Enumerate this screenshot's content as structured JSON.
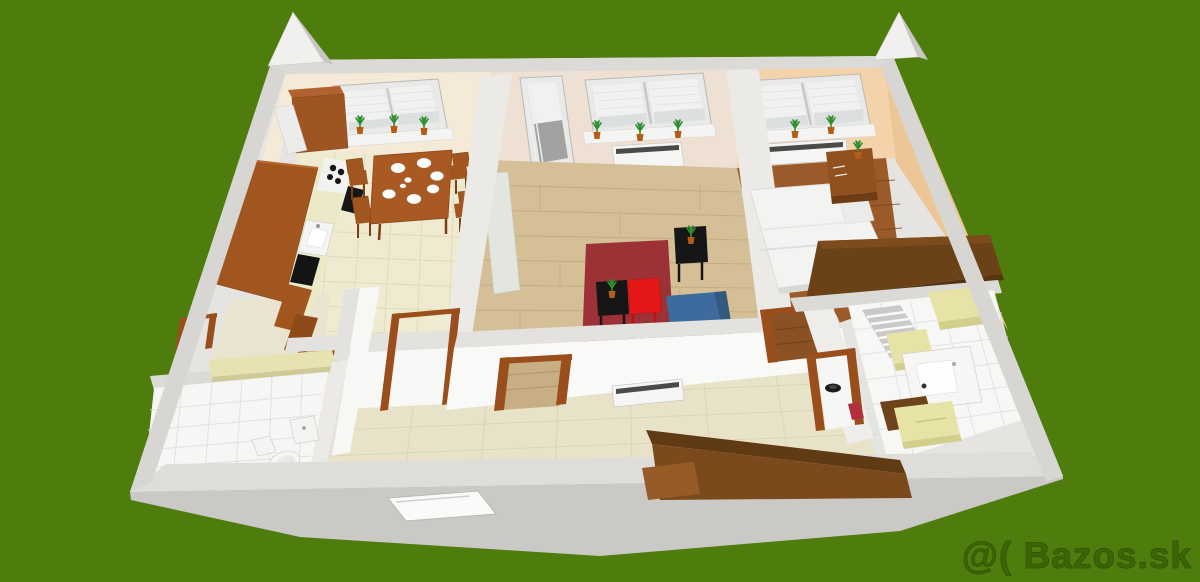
{
  "scene": {
    "type": "3d-floor-plan-render",
    "watermark": "@( Bazos.sk"
  },
  "colors": {
    "bg-green": "#4e7d0e",
    "watermark": "#3c6407",
    "watermark-outline": "#2c4f04",
    "shell-base": "#e6e4e0",
    "wall-top": "#e4e2de",
    "wall-top2": "#dfddd9",
    "wall-band": "#d8d6d2",
    "wall-band-dark": "#dcdad6",
    "outer-face": "#cbc9c5",
    "gable": "#f1f0ee",
    "gable-side": "#c9c7c3",
    "wall-white": "#f8f8f6",
    "wall-speckle": "#eceae6",
    "wall-cream": "#f5e9d8",
    "wall-cream2": "#efe0d4",
    "wall-peach": "#f4d2aa",
    "wall-peach-east": "#edc698",
    "floor-kitchen": "#efebd0",
    "grid-kitchen": "#ddd6b6",
    "floor-living": "#d5bf96",
    "plank-living": "#bda37a",
    "floor-bedroom": "#9a5a2a",
    "plank-bedroom": "#7a441c",
    "floor-hall": "#e8e3c8",
    "grid-hall": "#d5cfb0",
    "floor-tile": "#f6f6f4",
    "grid-tile": "#dedede",
    "window-frame": "#e9e9e7",
    "blind": "#f0f1f0",
    "glass-low": "#dcdfdf",
    "door-glass-gray": "#a2a2a0",
    "radiator": "#f5f5f4",
    "radiator-slot": "#4a4a48",
    "cabinet": "#a2561f",
    "cabinet-dark": "#8f4a1a",
    "cabinet-top": "#b26230",
    "counter-cream": "#ece9c6",
    "appliance-black": "#151515",
    "table-wood": "#a85a22",
    "chair-edge": "#7a4015",
    "doorframe": "#9a4e1c",
    "door-wood": "#8a5224",
    "rug-red": "#9c3136",
    "table-red": "#e61717",
    "sofa-blue": "#3e6b9d",
    "sofa-blue-dark": "#34597f",
    "side-table-black": "#161616",
    "bed-white": "#f3f3f1",
    "wardrobe": "#6b4218",
    "wardrobe-top": "#7c4c1c",
    "wardrobe-dark": "#55340f",
    "nightstand": "#91511f",
    "hall-sofa": "#7a4a1d",
    "hall-sofa-back": "#5f3a12",
    "hall-sofa-arm": "#965b26",
    "basket": "#e7e3a6",
    "basket-side": "#d2ce8c",
    "shelf": "#e7e2b2",
    "plant-green": "#2f8f2f",
    "pot": "#b55c16",
    "steel": "#c9c9c7",
    "threshold": "#7a3f16"
  }
}
